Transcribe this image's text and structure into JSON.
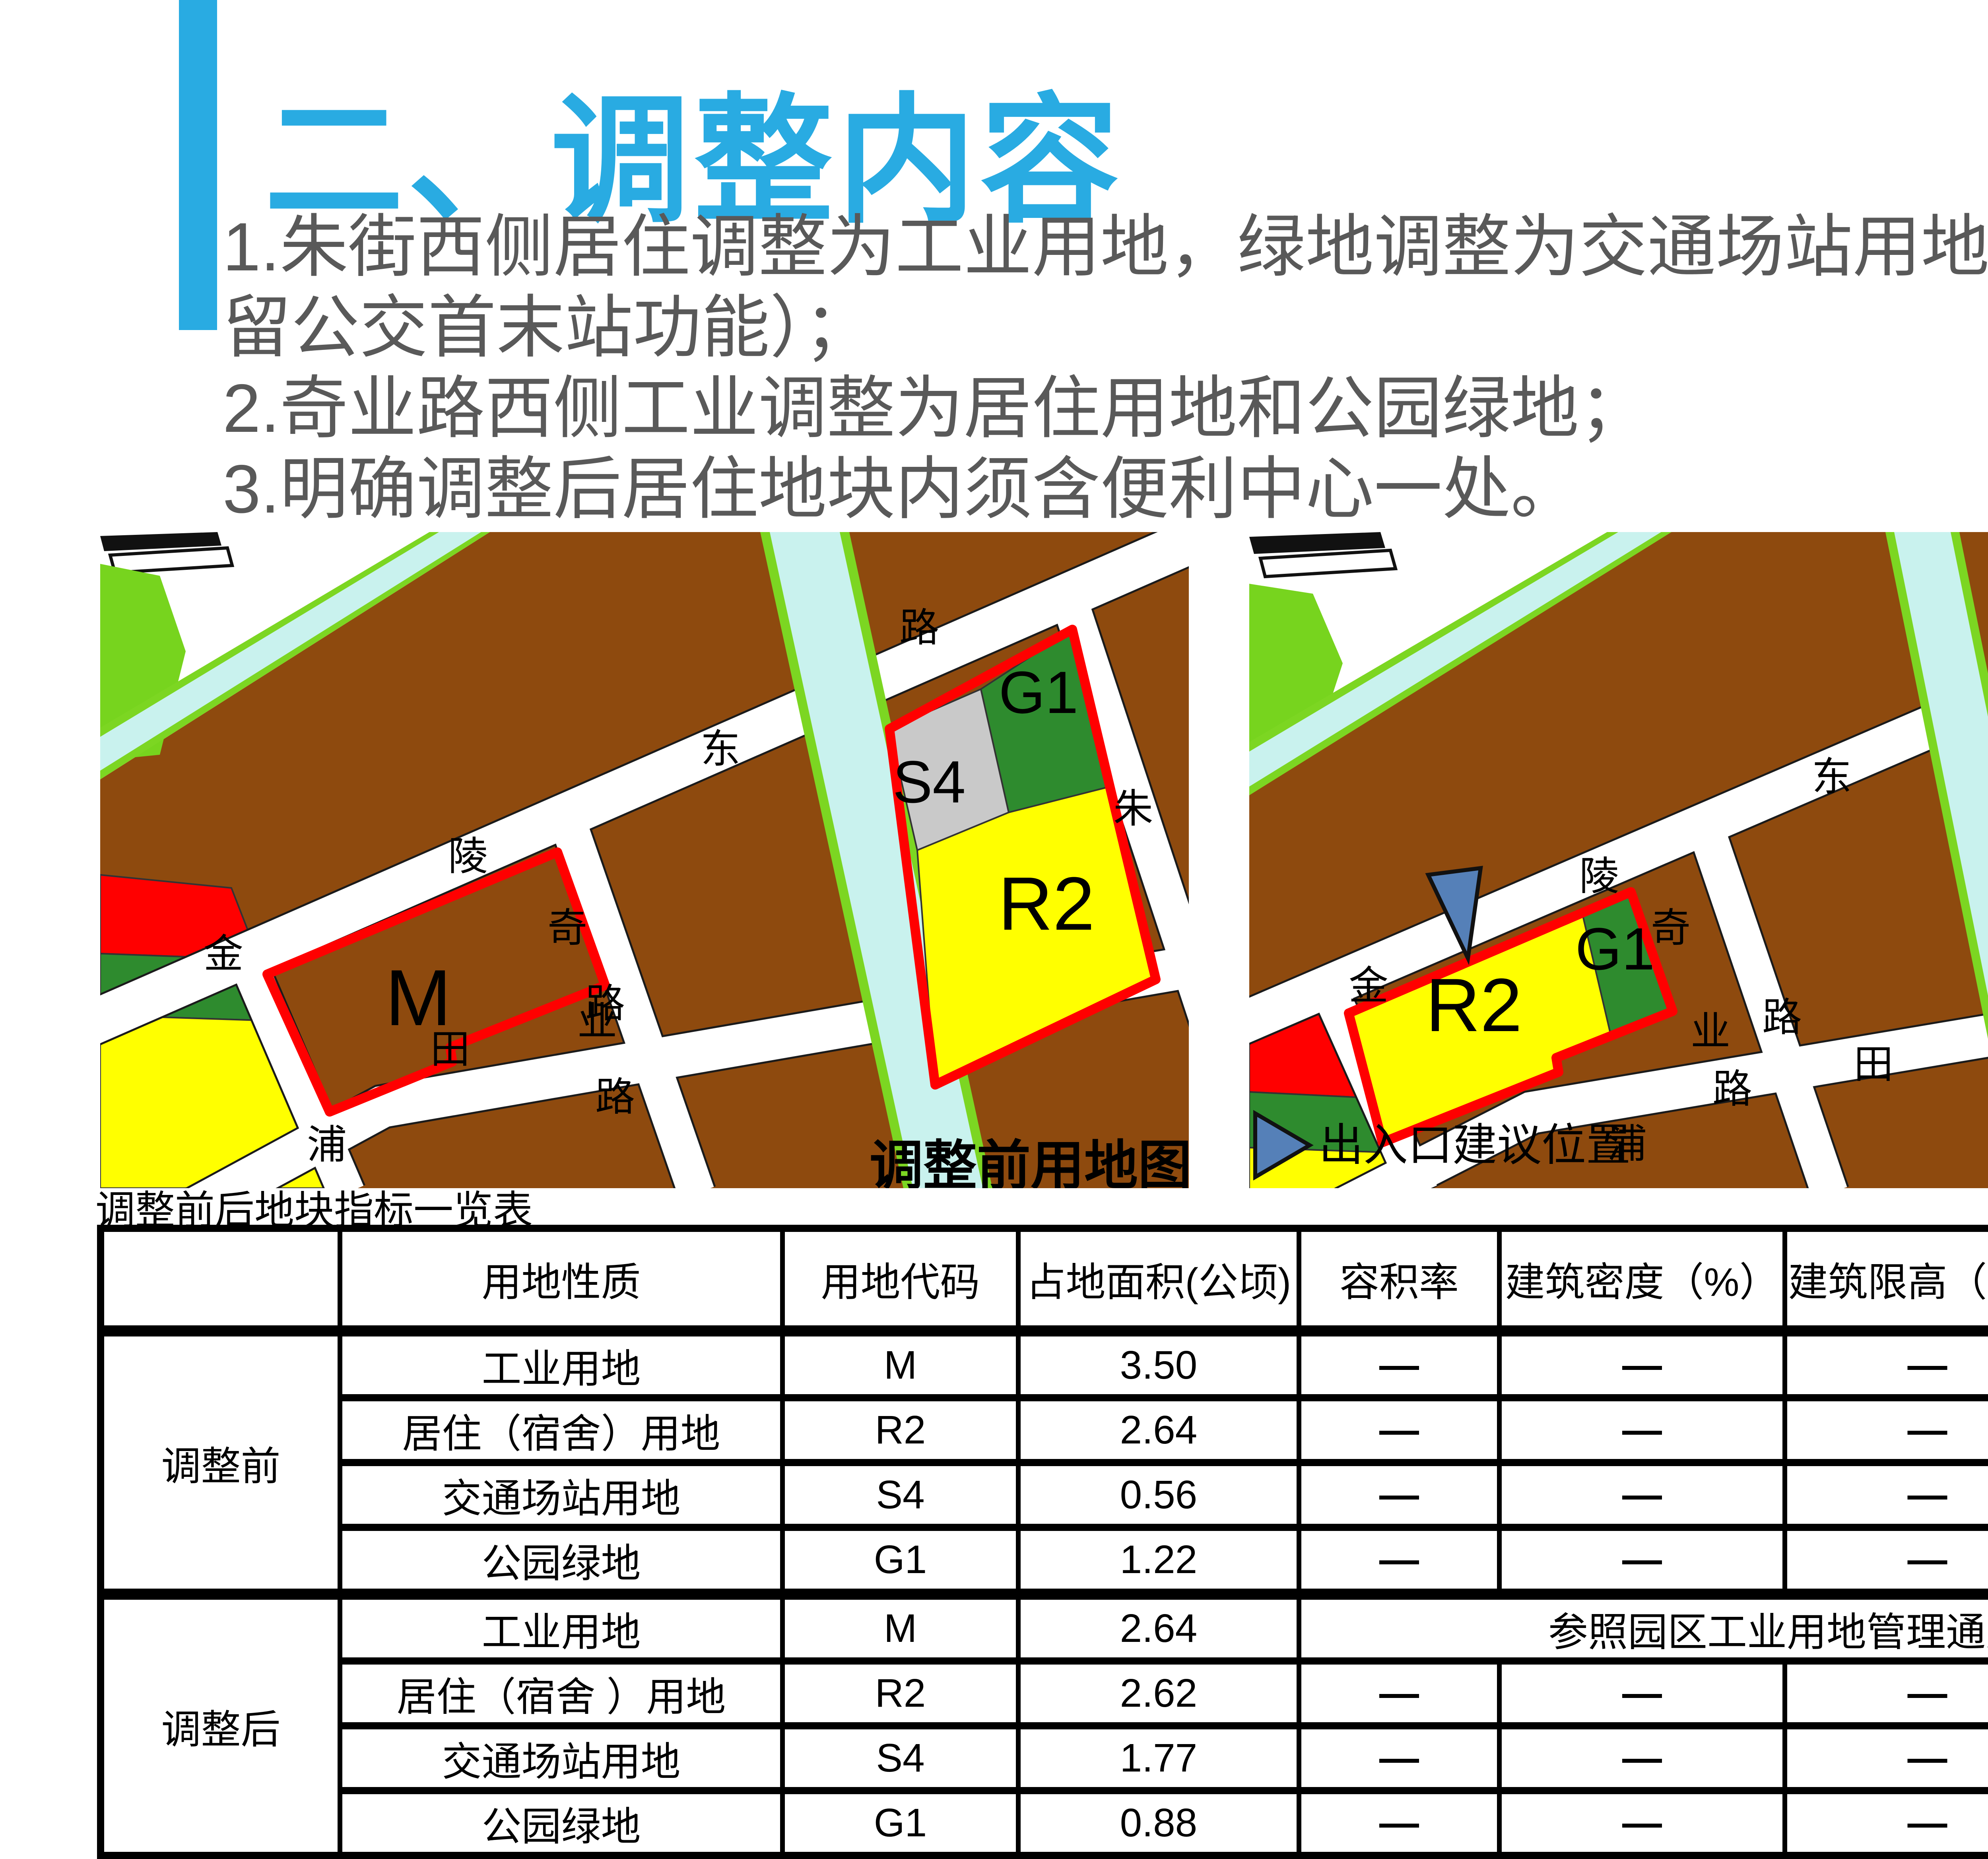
{
  "colors": {
    "accent": "#29ABE2",
    "body_text": "#595959",
    "land": "#8E4A0E",
    "road": "#FFFFFF",
    "river": "#C9F2EE",
    "green_edge": "#7CD622",
    "bright_green": "#77D41E",
    "park_green": "#2E8B2E",
    "residential_yellow": "#FFFF00",
    "transport_gray": "#C9C9C9",
    "red": "#FF0000",
    "arrow_blue": "#5580B8",
    "black": "#111111"
  },
  "header": {
    "section_title": "二、调整内容"
  },
  "notes": {
    "line1": "1.朱街西侧居住调整为工业用地，绿地调整为交通场站用地（保",
    "line2": "留公交首末站功能）；",
    "line3": "2.奇业路西侧工业调整为居住用地和公园绿地；",
    "line4": "3.明确调整后居住地块内须含便利中心一处。"
  },
  "maps": {
    "before": {
      "caption": "调整前用地图",
      "labels": {
        "jin": "金",
        "ling": "陵",
        "dong": "东",
        "lu1": "路",
        "qi": "奇",
        "ye": "业",
        "lu2": "路",
        "zhu": "朱",
        "jie": "街",
        "pu": "浦",
        "tian": "田",
        "lu3": "路",
        "s4": "S4",
        "g1": "G1",
        "r2": "R2",
        "m": "M"
      }
    },
    "after": {
      "caption": "调整后用地图",
      "legend_label": "出入口建议位置",
      "labels": {
        "jin": "金",
        "ling": "陵",
        "dong": "东",
        "lu1": "路",
        "qi": "奇",
        "ye": "业",
        "lu2": "路",
        "zhu": "朱",
        "jie": "街",
        "pu": "浦",
        "tian": "田",
        "lu3": "路",
        "s4": "S4",
        "g1": "G1",
        "r2": "R2",
        "m": "M",
        "b": "B"
      }
    }
  },
  "table": {
    "title": "调整前后地块指标一览表",
    "headers": [
      "",
      "用地性质",
      "用地代码",
      "占地面积(公顷)",
      "容积率",
      "建筑密度（%）",
      "建筑限高（米）",
      "绿化率（%）"
    ],
    "group_before": "调整前",
    "group_after": "调整后",
    "dash": "—",
    "before_rows": [
      {
        "nature": "工业用地",
        "code": "M",
        "area": "3.50"
      },
      {
        "nature": "居住（宿舍）用地",
        "code": "R2",
        "area": "2.64"
      },
      {
        "nature": "交通场站用地",
        "code": "S4",
        "area": "0.56"
      },
      {
        "nature": "公园绿地",
        "code": "G1",
        "area": "1.22"
      }
    ],
    "after_rows": [
      {
        "nature": "工业用地",
        "code": "M",
        "area": "2.64"
      },
      {
        "nature": "居住（宿舍 ）用地",
        "code": "R2",
        "area": "2.62"
      },
      {
        "nature": "交通场站用地",
        "code": "S4",
        "area": "1.77"
      },
      {
        "nature": "公园绿地",
        "code": "G1",
        "area": "0.88"
      }
    ],
    "after_m_note": "参照园区工业用地管理通则控制"
  }
}
